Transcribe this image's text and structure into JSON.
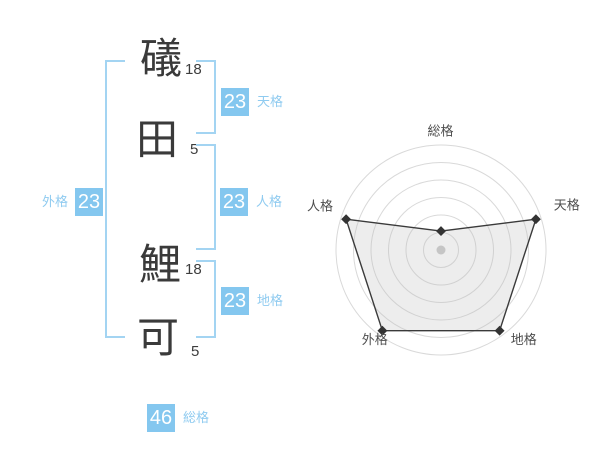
{
  "name_panel": {
    "characters": [
      {
        "char": "礒",
        "strokes": "18"
      },
      {
        "char": "田",
        "strokes": "5"
      },
      {
        "char": "鯉",
        "strokes": "18"
      },
      {
        "char": "可",
        "strokes": "5"
      }
    ],
    "badges": {
      "tenkaku": {
        "value": "23",
        "label": "天格"
      },
      "jinkaku": {
        "value": "23",
        "label": "人格"
      },
      "chikaku": {
        "value": "23",
        "label": "地格"
      },
      "gaikaku": {
        "value": "23",
        "label": "外格"
      },
      "soukaku": {
        "value": "46",
        "label": "総格"
      }
    },
    "colors": {
      "badge_bg": "#84c7ef",
      "label_text": "#8fcbf0",
      "bracket": "#a3d4f2"
    }
  },
  "chart_data": {
    "type": "radar",
    "axes": [
      "総格",
      "天格",
      "地格",
      "外格",
      "人格"
    ],
    "values_pct": [
      18,
      95,
      95,
      95,
      95
    ],
    "max_pct": 100,
    "rings": 6,
    "angles_deg": [
      90,
      18,
      -54,
      -126,
      -198
    ],
    "center": [
      141,
      140
    ],
    "radius": 105,
    "width": 290,
    "height": 255,
    "label_pos": [
      [
        140.5,
        21
      ],
      [
        266.7,
        95
      ],
      [
        223.8,
        229.5
      ],
      [
        74.7,
        229.5
      ],
      [
        20,
        96
      ]
    ],
    "grid_color": "#d9d9d9",
    "series_stroke": "#3a3a3a",
    "series_fill": "rgba(190,190,190,0.28)",
    "point_color": "#333333",
    "center_dot_color": "#c5c5c5",
    "label_color": "#4d4d4d",
    "legend": "none",
    "grid": "circular"
  }
}
